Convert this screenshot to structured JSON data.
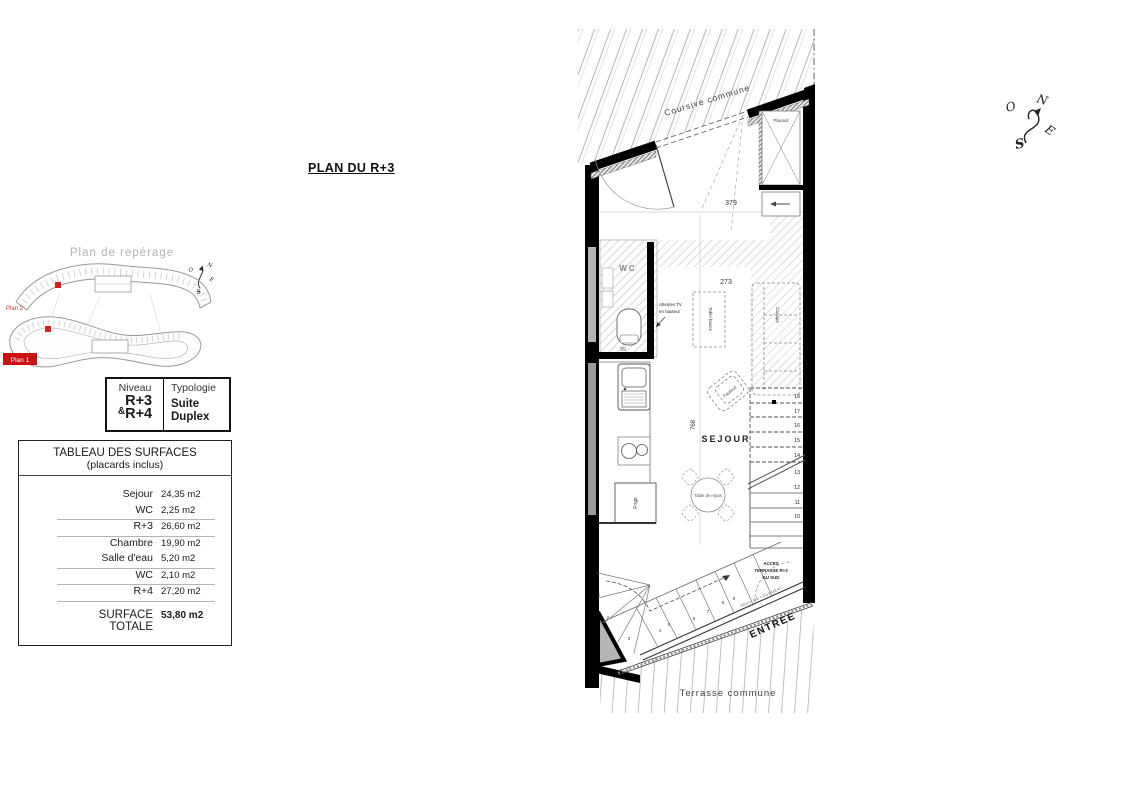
{
  "title": "PLAN DU R+3",
  "compass": {
    "n": "N",
    "o": "O",
    "e": "E",
    "s": "S"
  },
  "reperage": {
    "title": "Plan de repérage",
    "plan2": "Plan 2",
    "plan1": "Plan 1"
  },
  "level_table": {
    "niveau_header": "Niveau",
    "typologie_header": "Typologie",
    "amp": "&",
    "niveau1": "R+3",
    "niveau2": "R+4",
    "typo1": "Suite",
    "typo2": "Duplex"
  },
  "surfaces": {
    "title": "TABLEAU DES SURFACES",
    "subtitle": "(placards inclus)",
    "rows": [
      {
        "label": "Sejour",
        "value": "24,35 m2"
      },
      {
        "label": "WC",
        "value": "2,25 m2"
      },
      {
        "label": "R+3",
        "value": "26,60 m2"
      },
      {
        "label": "Chambre",
        "value": "19,90 m2"
      },
      {
        "label": "Salle d'eau",
        "value": "5,20 m2"
      },
      {
        "label": "WC",
        "value": "2,10 m2"
      },
      {
        "label": "R+4",
        "value": "27,20 m2"
      }
    ],
    "total_label": "SURFACE TOTALE",
    "total_value": "53,80 m2"
  },
  "plan": {
    "coursive": "Coursive commune",
    "terrasse": "Terrasse commune",
    "placard": "Placard",
    "wc": "WC",
    "sejour": "SEJOUR",
    "frigo": "Frigo",
    "canape": "Canapé",
    "table_basse": "Table basse",
    "fauteuil": "Fauteuil",
    "table_repas": "Table de repas",
    "attentes_tv_1": "Attentes TV",
    "attentes_tv_2": "en hauteur",
    "entree": "ENTREE",
    "acces_1": "ACCES",
    "acces_2": "TERRASSE R+3",
    "acces_3": "AU SUD",
    "seuil": "SEUIL DE LOGEMENT",
    "dim_379": "379",
    "dim_273": "273",
    "dim_768": "768",
    "dim_99": "99",
    "steps_upper": [
      "18",
      "17",
      "16",
      "15",
      "14",
      "13",
      "12",
      "11",
      "10"
    ],
    "steps_lower": [
      "1",
      "2",
      "3",
      "4",
      "5",
      "6",
      "7",
      "8",
      "9"
    ]
  },
  "colors": {
    "marker_red": "#cc2222",
    "wall_black": "#000000",
    "hatch_gray": "#c0c0c0"
  }
}
